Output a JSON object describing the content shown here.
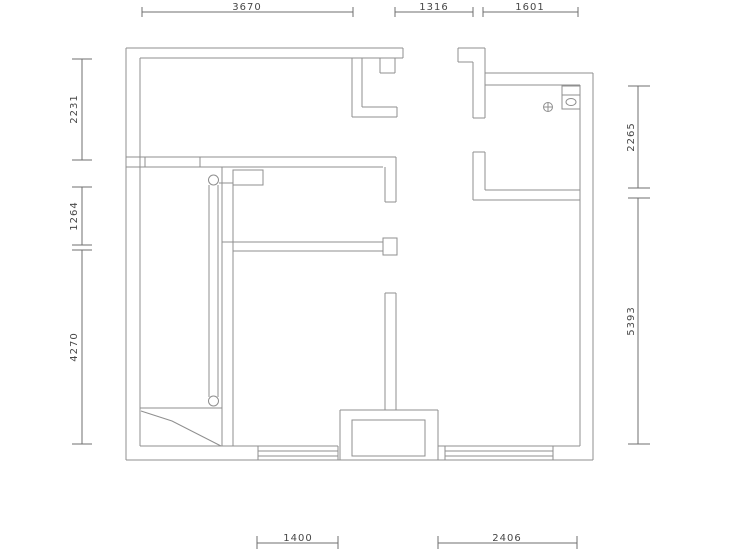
{
  "drawing": {
    "type": "floor-plan",
    "colors": {
      "wall_line": "#8f8f8f",
      "dim_line": "#6f6f6f",
      "dim_text": "#474747",
      "background": "#ffffff"
    },
    "dims": {
      "top": [
        {
          "label": "3670"
        },
        {
          "label": "1316"
        },
        {
          "label": "1601"
        }
      ],
      "left": [
        {
          "label": "2231"
        },
        {
          "label": "1264"
        },
        {
          "label": "4270"
        }
      ],
      "right": [
        {
          "label": "2265"
        },
        {
          "label": "5393"
        }
      ],
      "bottom": [
        {
          "label": "1400"
        },
        {
          "label": "2406"
        }
      ]
    },
    "symbols": [
      {
        "name": "floor-drain"
      },
      {
        "name": "washbasin-box"
      },
      {
        "name": "wardrobe-rail"
      }
    ]
  }
}
